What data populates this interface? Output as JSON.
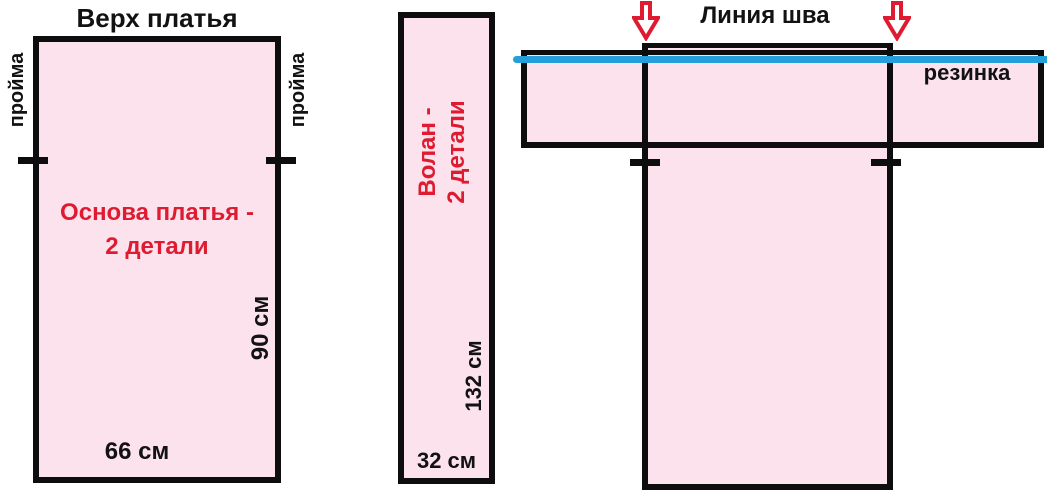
{
  "colors": {
    "pink": "#fce2ec",
    "red": "#de1b31",
    "cyan": "#249fdb",
    "line": "#0d0d0d"
  },
  "left_piece": {
    "title": "Верх платья",
    "armhole_left": "пройма",
    "armhole_right": "пройма",
    "label_line1": "Основа платья -",
    "label_line2": "2 детали",
    "height_dim": "90 см",
    "width_dim": "66 см"
  },
  "middle_piece": {
    "label_line1": "Волан -",
    "label_line2": "2 детали",
    "height_dim": "132 см",
    "width_dim": "32 см"
  },
  "assembly": {
    "title": "Линия шва",
    "elastic_label": "резинка",
    "arrow_icon": "red-down-arrow"
  }
}
